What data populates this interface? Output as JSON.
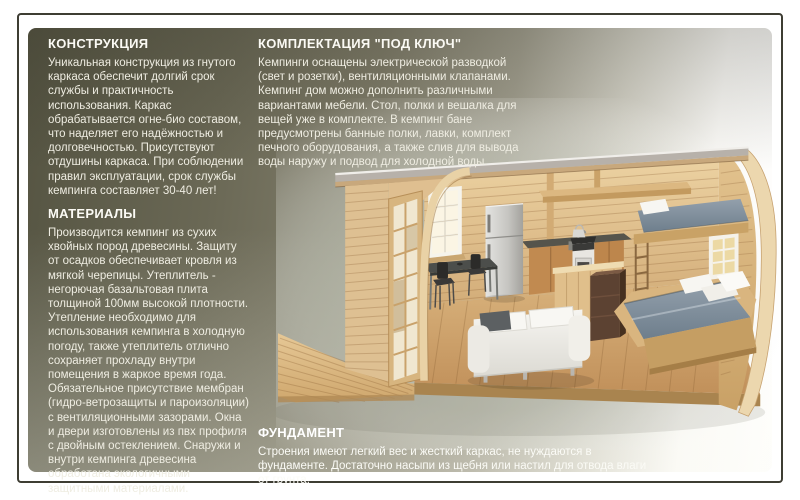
{
  "page": {
    "type": "brochure-page",
    "language": "ru",
    "border_color": "#3e3d33",
    "panel_colors": {
      "top_left": "#4d4c3c",
      "bottom_left": "#83816e",
      "right": "#ffffff"
    }
  },
  "sections": {
    "construction": {
      "title": "КОНСТРУКЦИЯ",
      "body": "Уникальная конструкция из гнутого каркаса обеспечит долгий срок службы и практичность использования. Каркас обрабатывается огне-био составом, что наделяет его надёжностью и долговечностью. Присутствуют отдушины каркаса. При соблюдении правил эксплуатации, срок службы кемпинга составляет 30-40 лет!"
    },
    "materials": {
      "title": "МАТЕРИАЛЫ",
      "body": "Производится кемпинг из сухих хвойных пород древесины. Защиту от осадков обеспечивает кровля из мягкой черепицы. Утеплитель - негорючая базальтовая плита толщиной 100мм высокой плотности. Утепление необходимо для использования кемпинга в холодную погоду, также утеплитель отлично сохраняет прохладу внутри помещения в жаркое время года. Обязательное присутствие мембран (гидро-ветрозащиты и пароизоляции) с вентиляционными зазорами. Окна и двери изготовлены из пвх профиля с двойным остеклением. Снаружи и внутри кемпинга древесина обработана экологичными защитными материалами."
    },
    "turnkey": {
      "title": "КОМПЛЕКТАЦИЯ \"ПОД КЛЮЧ\"",
      "body": "Кемпинги оснащены электрической разводкой (свет и розетки), вентиляционными клапанами. Кемпинг дом можно дополнить различными вариантами мебели. Стол, полки и вешалка для вещей уже в комплекте. В кемпинг бане предусмотрены банные полки, лавки, комплект печного оборудования, а также слив для вывода воды наружу и подвод для холодной воды."
    },
    "foundation": {
      "title": "ФУНДАМЕНТ",
      "body": "Строения имеют легкий вес и жесткий каркас, не нуждаются в фундаменте. Достаточно насыпи из щебня или настил для отвода влаги от грунта."
    }
  },
  "illustration": {
    "description": "3D cutaway of an arched (barrel-roof) wooden camping cabin: glazed door and deck on the left, kitchen with fridge, stove, sink and dining table in the middle, white sofa in front, double bed with grey duvet and a loft bunk bed on the right, small grid windows",
    "colors": {
      "wood_light": "#e6c896",
      "wood_floor": "#c99a63",
      "roof_grey": "#b7b1aa",
      "duvet_grey_blue": "#8593a0",
      "sofa_white": "#f3f2ed",
      "backdrop_sage": "#b7bbac"
    }
  }
}
